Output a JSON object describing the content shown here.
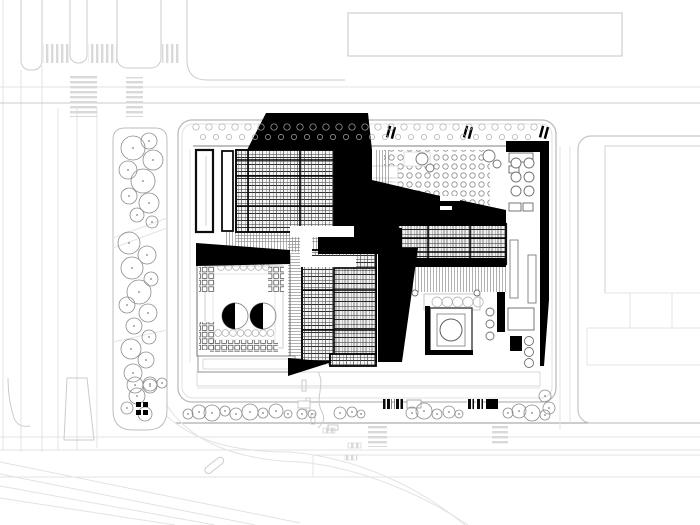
{
  "scene": {
    "kind": "architectural-site-plan",
    "elements": [
      "road-network",
      "left-tree-strip",
      "site-block",
      "northwest-roof",
      "northeast-plaza",
      "east-roof",
      "south-roof",
      "southwest-courtyard-building",
      "right-service-strip",
      "top-neighbor-building",
      "right-neighbor-building",
      "bottom-promenade",
      "tram-tracks"
    ]
  },
  "palette": {
    "paper": "#ffffff",
    "ink": "#000000",
    "roof_hatch": "#1a1a1a",
    "line_faint": "#e3e3e3",
    "line_light": "#cbcbcb",
    "line_mid": "#9a9a9a",
    "tree": "#8c8c8c"
  },
  "trees": {
    "top_row_a": {
      "y": 127,
      "x0": 196,
      "x1": 534,
      "step": 13,
      "r": 3.2
    },
    "top_row_b": {
      "y": 137,
      "x0": 203,
      "x1": 528,
      "step": 13,
      "r": 2.6
    },
    "sw_court_row": {
      "y": 267,
      "x0": 221,
      "x1": 266,
      "step": 7.5,
      "r": 3.4
    },
    "sw_court_row2": {
      "y": 333,
      "x0": 218,
      "x1": 272,
      "step": 7.5,
      "r": 3.4
    },
    "pavilion_row": {
      "y": 302,
      "x0": 437,
      "x1": 488,
      "step": 10.3,
      "r": 5
    },
    "left_strip": [
      [
        133,
        148,
        12
      ],
      [
        149,
        141,
        8
      ],
      [
        153,
        160,
        10
      ],
      [
        128,
        170,
        9
      ],
      [
        143,
        181,
        12
      ],
      [
        129,
        196,
        8
      ],
      [
        149,
        203,
        10
      ],
      [
        137,
        215,
        7
      ],
      [
        152,
        222,
        6
      ],
      [
        129,
        243,
        11
      ],
      [
        147,
        255,
        9
      ],
      [
        132,
        268,
        11
      ],
      [
        151,
        279,
        7
      ],
      [
        139,
        292,
        12
      ],
      [
        127,
        305,
        8
      ],
      [
        148,
        313,
        9
      ],
      [
        134,
        326,
        8
      ],
      [
        149,
        337,
        7
      ],
      [
        131,
        349,
        10
      ],
      [
        146,
        360,
        8
      ],
      [
        133,
        373,
        9
      ],
      [
        150,
        384,
        7
      ],
      [
        137,
        396,
        8
      ],
      [
        127,
        408,
        6
      ],
      [
        145,
        414,
        7
      ]
    ],
    "bottom_row": [
      [
        188,
        414,
        5
      ],
      [
        199,
        412,
        7
      ],
      [
        212,
        413,
        8
      ],
      [
        225,
        411,
        5
      ],
      [
        236,
        414,
        6
      ],
      [
        250,
        412,
        8
      ],
      [
        263,
        413,
        5
      ],
      [
        276,
        411,
        7
      ],
      [
        288,
        414,
        4
      ],
      [
        340,
        413,
        6
      ],
      [
        352,
        412,
        5
      ],
      [
        361,
        414,
        4
      ],
      [
        412,
        413,
        6
      ],
      [
        424,
        411,
        8
      ],
      [
        437,
        414,
        5
      ],
      [
        449,
        412,
        6
      ],
      [
        459,
        414,
        4
      ],
      [
        508,
        413,
        5
      ],
      [
        519,
        411,
        7
      ],
      [
        532,
        413,
        8
      ],
      [
        545,
        415,
        5
      ],
      [
        135,
        385,
        8
      ],
      [
        150,
        386,
        7
      ],
      [
        162,
        383,
        5
      ],
      [
        545,
        396,
        6
      ],
      [
        549,
        408,
        6
      ]
    ],
    "median_pair": [
      [
        302,
        414,
        5
      ],
      [
        312,
        414,
        4
      ]
    ]
  },
  "detail_circles": [
    [
      516,
      163,
      5
    ],
    [
      529,
      163,
      5
    ],
    [
      516,
      177,
      5
    ],
    [
      529,
      177,
      5
    ],
    [
      516,
      191,
      5
    ],
    [
      529,
      191,
      5
    ],
    [
      529,
      341,
      4.5
    ],
    [
      529,
      352,
      4.5
    ],
    [
      529,
      363,
      4.5
    ],
    [
      490,
      312,
      4
    ],
    [
      490,
      324,
      4
    ],
    [
      490,
      336,
      4
    ],
    [
      422,
      159,
      6
    ],
    [
      430,
      168,
      4
    ],
    [
      489,
      156,
      6
    ],
    [
      497,
      164,
      4
    ],
    [
      415,
      293,
      3
    ],
    [
      477,
      293,
      3
    ]
  ]
}
